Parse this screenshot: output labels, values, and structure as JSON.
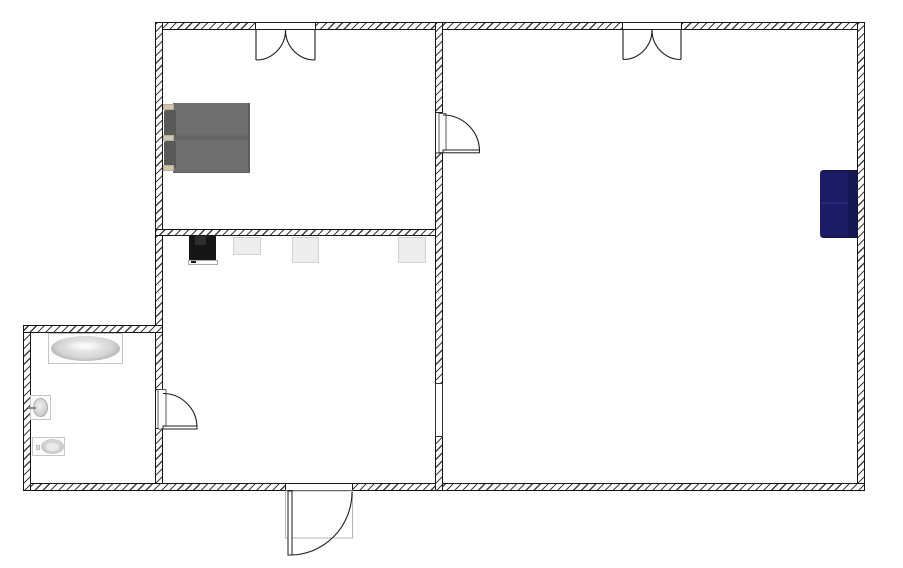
{
  "canvas": {
    "type": "2d-floor-plan",
    "width": 903,
    "height": 568,
    "background": "#ffffff"
  },
  "colors": {
    "wall-line": "#161616",
    "wall-hatch": "#3f3f3f",
    "wall-fill": "#ffffff",
    "door-line": "#1c1c1c",
    "porch-line": "#b5b5b5",
    "bed-mattress": "#6f6f6f",
    "bed-mattress-dark": "#626262",
    "bed-pillow": "#595959",
    "bed-trim": "#cfc6ae",
    "stove-body": "#161616",
    "stove-burner": "#2e2e2e",
    "stove-panel-border": "#ababab",
    "counter-fill": "#ededed",
    "counter-border": "#d2d2d2",
    "sofa-body": "#1d1d67",
    "sofa-back": "#15154f",
    "sofa-seam": "#28287c",
    "fixture-border": "#c6c6c6",
    "fixture-rim": "#a8a8a8",
    "fixture-mid": "#d5d5d5",
    "fixture-light": "#efefef"
  },
  "plan": {
    "rooms": [
      {
        "name": "bedroom",
        "position": "top-left",
        "furniture": [
          "double-bed"
        ]
      },
      {
        "name": "kitchen-living-room",
        "position": "bottom-left",
        "furniture": [
          "stove",
          "counter-1",
          "counter-2",
          "counter-3"
        ]
      },
      {
        "name": "main-room",
        "position": "right",
        "furniture": [
          "sofa"
        ]
      },
      {
        "name": "bathroom",
        "position": "bottom-left-annex",
        "furniture": [
          "bathtub",
          "sink",
          "toilet"
        ]
      }
    ],
    "doors": [
      {
        "name": "bedroom-double-door",
        "wall": "top",
        "type": "double-swing"
      },
      {
        "name": "main-room-double-door",
        "wall": "top",
        "type": "double-swing"
      },
      {
        "name": "interior-door",
        "wall": "center-divider",
        "type": "single-swing"
      },
      {
        "name": "bathroom-door",
        "wall": "bathroom-divider",
        "type": "single-swing"
      },
      {
        "name": "front-door",
        "wall": "bottom",
        "type": "single-swing-outward"
      }
    ],
    "windows": [
      {
        "name": "divider-wall-opening",
        "wall": "center-divider"
      }
    ]
  }
}
